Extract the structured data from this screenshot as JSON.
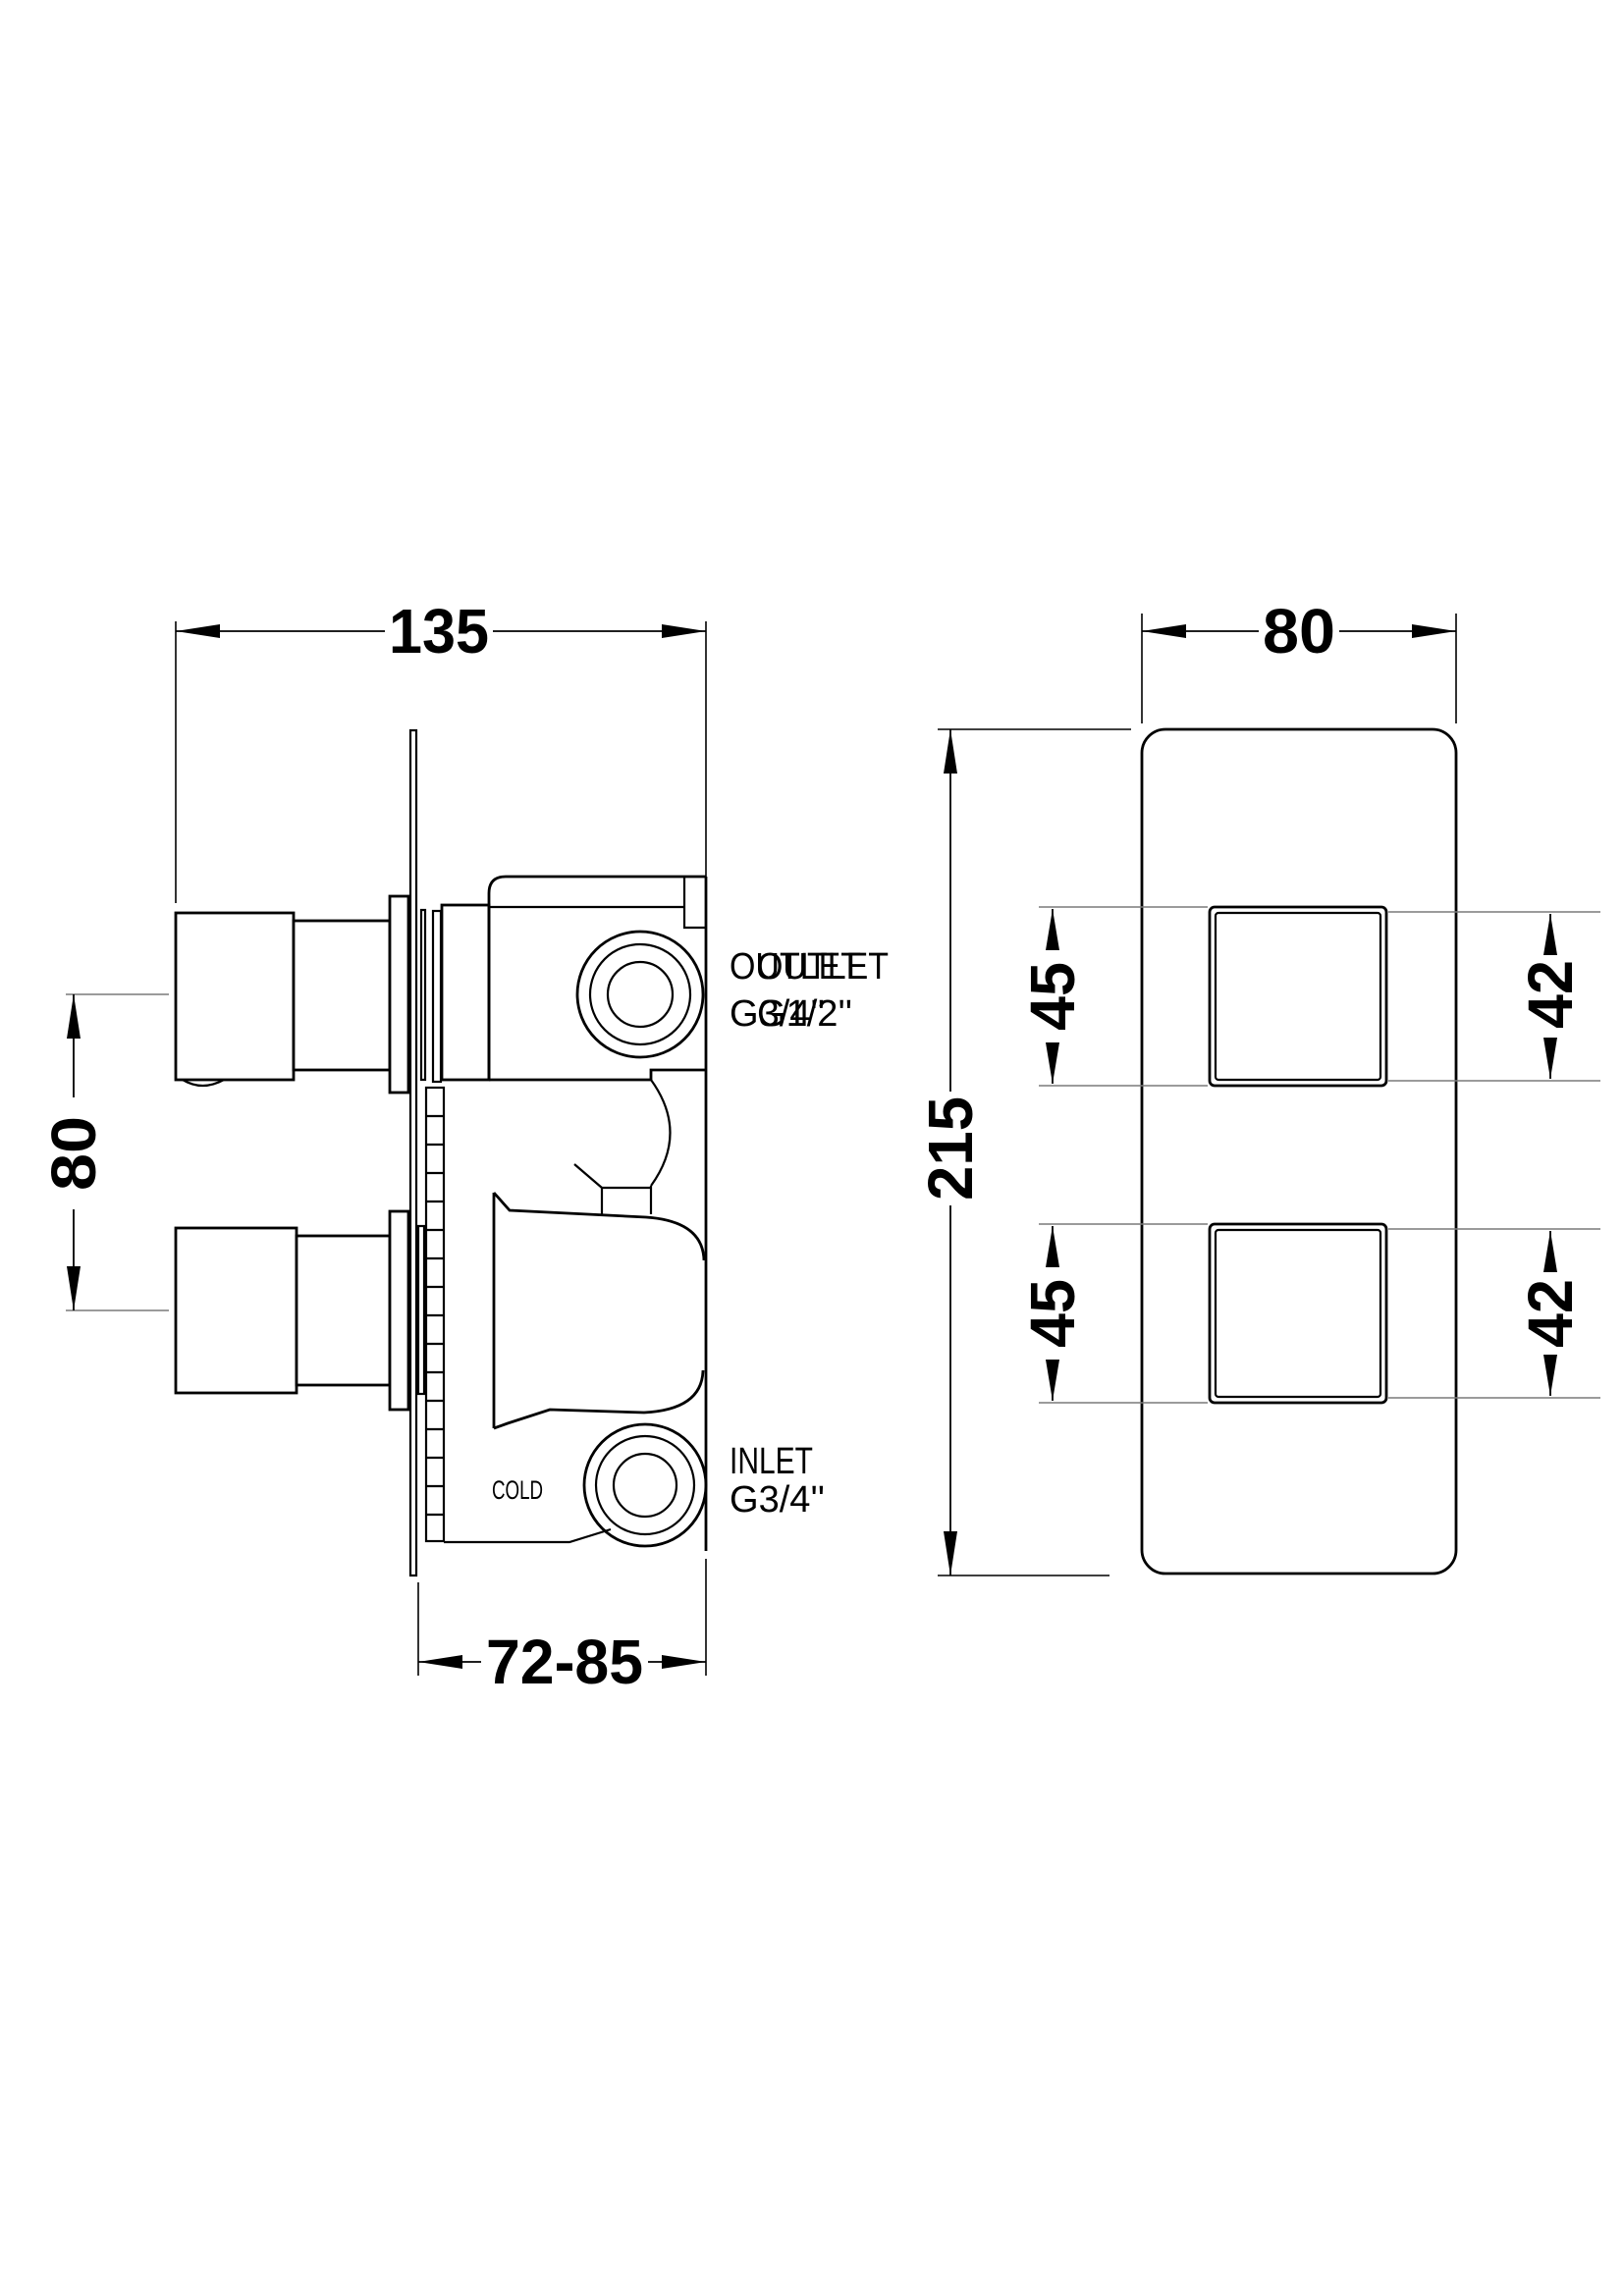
{
  "page": {
    "background": "#ffffff",
    "line_color": "#000000",
    "ext_line_color": "#7a7a7a"
  },
  "side_view": {
    "dims": {
      "width": "135",
      "handle_spacing": "80",
      "wall_depth": "72-85"
    },
    "labels": {
      "outlet_primary": {
        "line1": "OUTLET",
        "line2": "G3/4''"
      },
      "outlet_secondary": {
        "line1": "OUTLET",
        "line2": "G1/2''"
      },
      "inlet": {
        "line1": "INLET",
        "line2": "G3/4''"
      },
      "cold": "COLD"
    }
  },
  "front_view": {
    "dims": {
      "width": "80",
      "height": "215",
      "upper_square_outer": "45",
      "lower_square_outer": "45",
      "upper_square_inner": "42",
      "lower_square_inner": "42"
    }
  }
}
